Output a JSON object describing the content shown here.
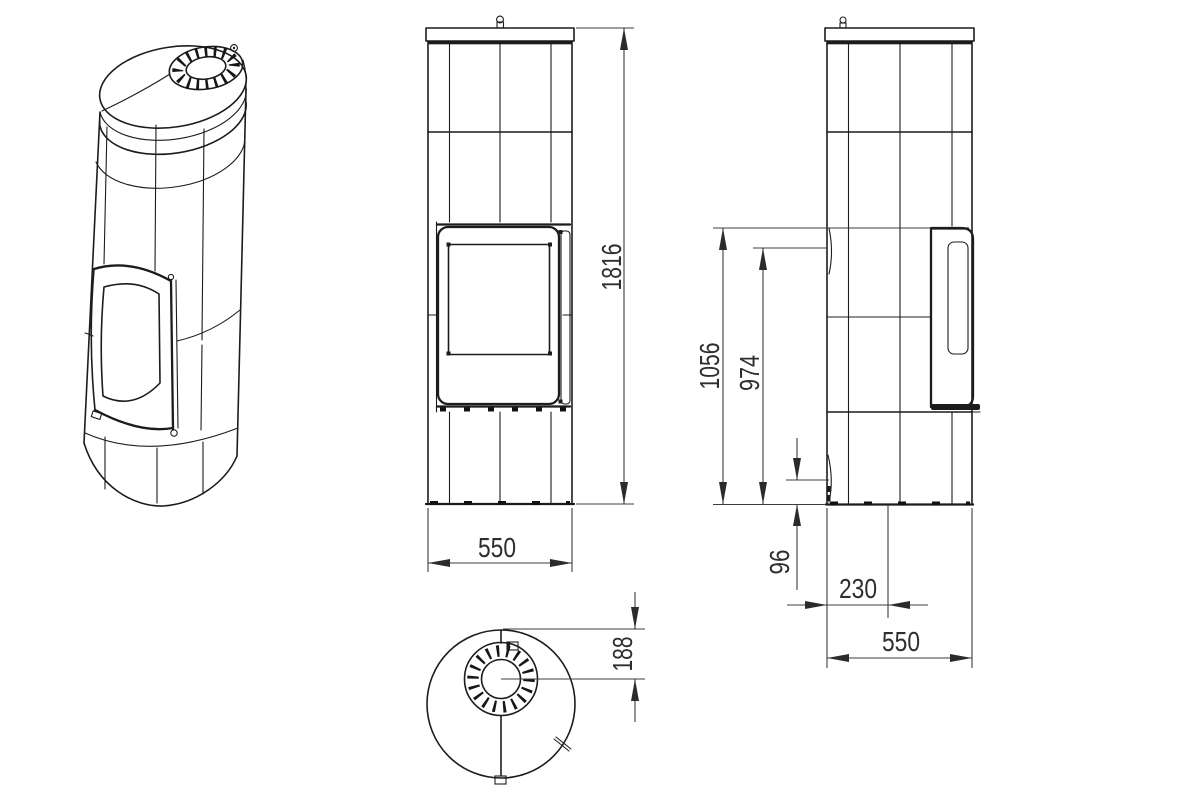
{
  "drawing": {
    "type": "technical-dimension-drawing",
    "subject": "cylindrical tiled stove, four views (isometric, front, side, top)",
    "colors": {
      "background": "#ffffff",
      "model_line": "#1c1c1c",
      "dimension_line": "#3d3d3d",
      "dimension_text": "#2e2e2e"
    },
    "dims": {
      "overall_height": "1816",
      "front_width": "550",
      "door_top_height": "1056",
      "glass_top_height": "974",
      "door_bottom_height": "96",
      "flue_center_offset": "230",
      "side_depth": "550",
      "top_flue_offset": "188"
    }
  }
}
